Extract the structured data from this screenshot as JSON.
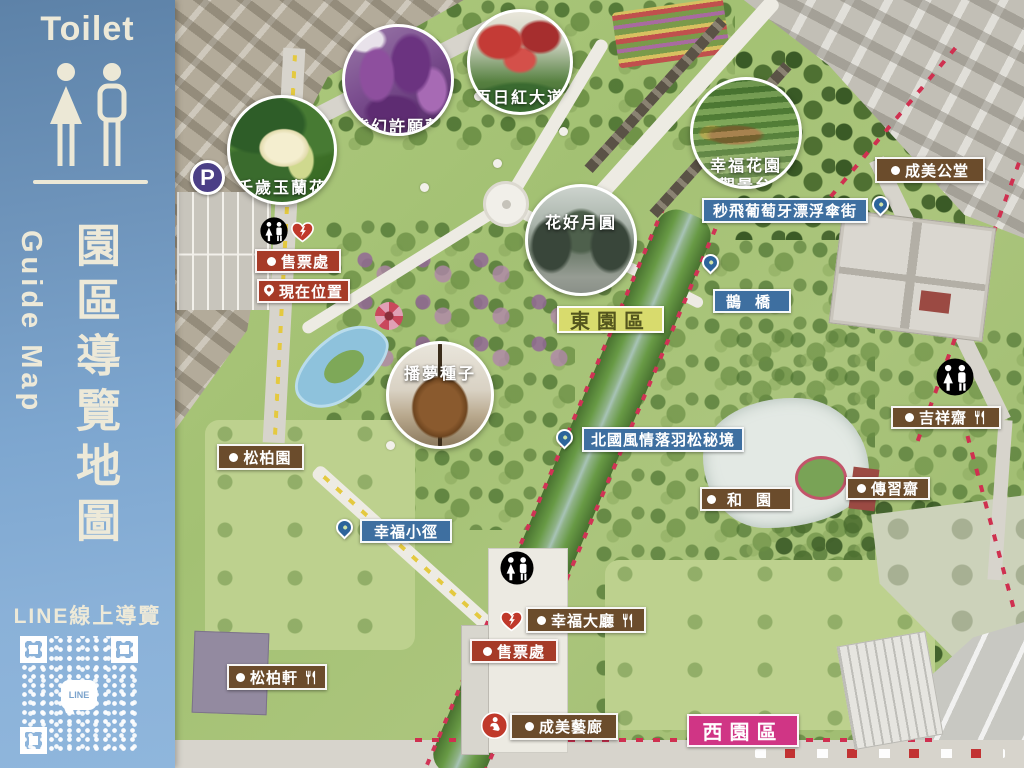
{
  "sidebar": {
    "toilet_heading": "Toilet",
    "guide_map_en": "Guide Map",
    "guide_map_zh": "園區導覽地圖",
    "line_label": "LINE線上導覽",
    "qr_center_text": "LINE"
  },
  "map": {
    "photo_circles": [
      {
        "label": "千歲玉蘭花",
        "subject": "magnolia",
        "cx": 107,
        "cy": 150,
        "r": 55,
        "ly": 76
      },
      {
        "label": "紫幻許願藤",
        "subject": "wisteria",
        "cx": 223,
        "cy": 80,
        "r": 56,
        "ly": 86
      },
      {
        "label": "百日紅大道",
        "subject": "crape",
        "cx": 345,
        "cy": 62,
        "r": 53,
        "ly": 72
      },
      {
        "label": "幸福花園",
        "label2": "觀景台",
        "subject": "garden",
        "cx": 571,
        "cy": 133,
        "r": 56,
        "ly": 72,
        "ly2": 92
      },
      {
        "label": "花好月圓",
        "subject": "gazebo",
        "cx": 406,
        "cy": 240,
        "r": 56,
        "ly": 22
      },
      {
        "label": "播夢種子",
        "subject": "seed",
        "cx": 265,
        "cy": 395,
        "r": 54,
        "ly": 16
      }
    ],
    "pois": [
      {
        "label": "售票處",
        "style": "red",
        "lead": "dot",
        "x": 80,
        "y": 249,
        "w": 86,
        "h": 24
      },
      {
        "label": "現在位置",
        "style": "red",
        "lead": "pin",
        "x": 82,
        "y": 279,
        "w": 86,
        "h": 24
      },
      {
        "label": "成美公堂",
        "style": "brown",
        "lead": "dot",
        "x": 700,
        "y": 157,
        "w": 110,
        "h": 26
      },
      {
        "label": "秒飛葡萄牙漂浮傘街",
        "style": "blue",
        "x": 527,
        "y": 198,
        "w": 166,
        "h": 25
      },
      {
        "label": "鵲橋",
        "style": "blue",
        "spaced": true,
        "x": 538,
        "y": 289,
        "w": 76,
        "h": 24
      },
      {
        "label": "東園區",
        "style": "yellow",
        "x": 382,
        "y": 306,
        "w": 107,
        "h": 27
      },
      {
        "label": "北國風情落羽松秘境",
        "style": "blue",
        "x": 407,
        "y": 427,
        "w": 162,
        "h": 25
      },
      {
        "label": "和園",
        "style": "brown",
        "lead": "dot",
        "spaced": true,
        "x": 525,
        "y": 487,
        "w": 88,
        "h": 24
      },
      {
        "label": "吉祥齋",
        "style": "brown",
        "lead": "dot",
        "utensils": true,
        "x": 716,
        "y": 406,
        "w": 110,
        "h": 23
      },
      {
        "label": "傳習齋",
        "style": "brown",
        "lead": "dot",
        "x": 671,
        "y": 477,
        "w": 84,
        "h": 23
      },
      {
        "label": "松柏園",
        "style": "brown",
        "lead": "dot",
        "x": 42,
        "y": 444,
        "w": 87,
        "h": 26
      },
      {
        "label": "幸福小徑",
        "style": "blue",
        "x": 185,
        "y": 519,
        "w": 92,
        "h": 24
      },
      {
        "label": "幸福大廳",
        "style": "brown",
        "lead": "dot",
        "utensils": true,
        "x": 351,
        "y": 607,
        "w": 120,
        "h": 26
      },
      {
        "label": "售票處",
        "style": "red",
        "lead": "dot",
        "x": 295,
        "y": 639,
        "w": 88,
        "h": 24
      },
      {
        "label": "松柏軒",
        "style": "brown",
        "lead": "dot",
        "utensils": true,
        "x": 52,
        "y": 664,
        "w": 100,
        "h": 26
      },
      {
        "label": "成美藝廊",
        "style": "brown",
        "lead": "dot",
        "x": 335,
        "y": 713,
        "w": 108,
        "h": 27
      },
      {
        "label": "西園區",
        "style": "pink",
        "x": 512,
        "y": 714,
        "w": 112,
        "h": 33
      }
    ],
    "pins": [
      {
        "x": 697,
        "y": 196
      },
      {
        "x": 527,
        "y": 254
      },
      {
        "x": 381,
        "y": 429
      },
      {
        "x": 161,
        "y": 519
      }
    ],
    "amenities": [
      {
        "kind": "parking",
        "label": "P",
        "x": 15,
        "y": 160,
        "s": 35
      },
      {
        "kind": "toilet",
        "x": 85,
        "y": 217,
        "s": 28
      },
      {
        "kind": "aed",
        "x": 115,
        "y": 219,
        "s": 25
      },
      {
        "kind": "toilet",
        "x": 761,
        "y": 358,
        "s": 38
      },
      {
        "kind": "toilet",
        "x": 325,
        "y": 551,
        "s": 34
      },
      {
        "kind": "aed",
        "x": 324,
        "y": 608,
        "s": 25
      },
      {
        "kind": "nursing",
        "x": 306,
        "y": 712,
        "s": 27
      }
    ],
    "colors": {
      "label_red": "#a63b28",
      "label_brown": "#6b4c2c",
      "label_blue": "#3e6fa0",
      "label_yellow": "#d8db6d",
      "label_pink": "#d03585",
      "sidebar_blue": "#7da6cf"
    }
  }
}
